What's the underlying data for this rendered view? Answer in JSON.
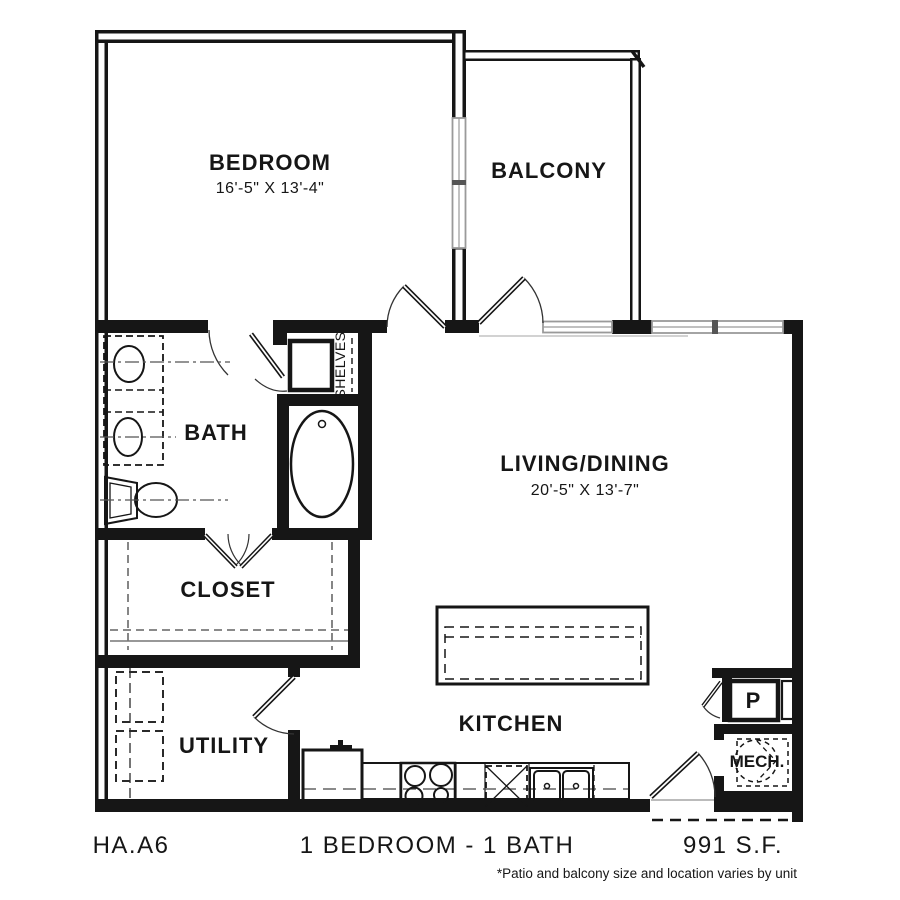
{
  "plan": {
    "rooms": {
      "bedroom": {
        "label": "BEDROOM",
        "dims": "16'-5\" X 13'-4\""
      },
      "balcony": {
        "label": "BALCONY"
      },
      "bath": {
        "label": "BATH"
      },
      "shelves": {
        "label": "SHELVES"
      },
      "living_dining": {
        "label": "LIVING/DINING",
        "dims": "20'-5\" X 13'-7\""
      },
      "closet": {
        "label": "CLOSET"
      },
      "utility": {
        "label": "UTILITY"
      },
      "kitchen": {
        "label": "KITCHEN"
      },
      "pantry": {
        "label": "P"
      },
      "mech": {
        "label": "MECH."
      }
    },
    "footer": {
      "plan_code": "HA.A6",
      "plan_type": "1 BEDROOM - 1 BATH",
      "area": "991 S.F.",
      "footnote": "*Patio and balcony size and location varies by unit"
    },
    "colors": {
      "line": "#161616",
      "window": "#9a9a9a",
      "background": "#ffffff"
    }
  }
}
